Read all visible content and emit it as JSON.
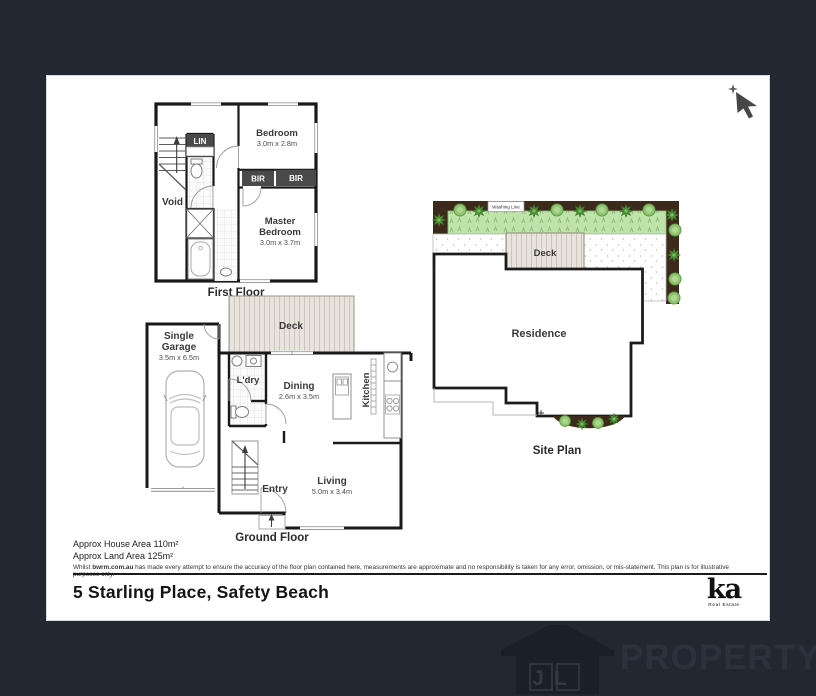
{
  "first_floor": {
    "label": "First Floor",
    "bedroom": "Bedroom",
    "bedroom_dims": "3.0m x 2.8m",
    "master1": "Master",
    "master2": "Bedroom",
    "master_dims": "3.0m x 3.7m",
    "void": "Void",
    "lin": "LIN",
    "bir_left": "BIR",
    "bir_right": "BIR"
  },
  "ground_floor": {
    "label": "Ground Floor",
    "garage1": "Single",
    "garage2": "Garage",
    "garage_dims": "3.5m x 6.5m",
    "deck": "Deck",
    "ldry": "L'dry",
    "dining": "Dining",
    "dining_dims": "2.6m x 3.5m",
    "kitchen": "Kitchen",
    "living": "Living",
    "living_dims": "5.0m x 3.4m",
    "entry": "Entry"
  },
  "site_plan": {
    "label": "Site Plan",
    "residence": "Residence",
    "deck": "Deck",
    "washing_line": "Washing Line"
  },
  "notes": {
    "house_area": "Approx House Area 110m²",
    "land_area": "Approx Land Area 125m²",
    "disclaimer_prefix": "Whilst ",
    "disclaimer_site": "bwrm.com.au",
    "disclaimer_rest": " has made every attempt to ensure the accuracy of the floor plan contained here, measurements are approximate and no responsibility is taken for any error, omission, or mis-statement. This plan is for illustrative purposes only."
  },
  "footer": {
    "address": "5 Starling Place, Safety Beach",
    "agency": "ka",
    "agency_sub": "Real Estate"
  },
  "watermark": {
    "initials": "JL",
    "brand": "PROPERTY"
  }
}
